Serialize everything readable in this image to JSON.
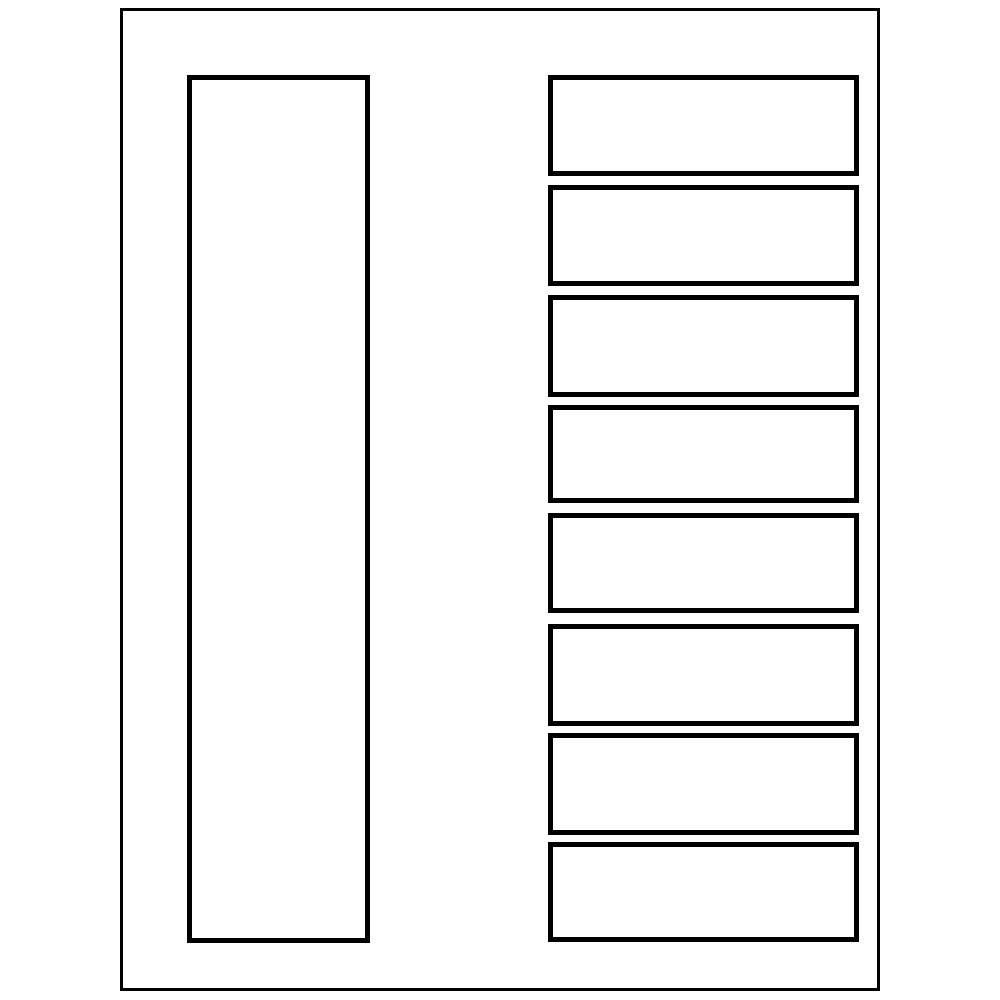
{
  "canvas": {
    "width": 1000,
    "height": 1000,
    "background_color": "#ffffff",
    "line_color": "#000000"
  },
  "page_border": {
    "name": "page-border",
    "x": 120,
    "y": 8,
    "width": 760,
    "height": 983,
    "stroke_width": 3,
    "stroke": "#000000",
    "fill": "#ffffff"
  },
  "left_label": {
    "name": "left-spine-label-outline",
    "x": 187,
    "y": 75,
    "width": 183,
    "height": 868,
    "stroke_width": 5,
    "stroke": "#000000",
    "fill": "#ffffff"
  },
  "right_labels": {
    "name_prefix": "right-label-outline",
    "x": 548,
    "width": 311,
    "stroke_width": 5,
    "stroke": "#000000",
    "fill": "#ffffff",
    "items": [
      {
        "index": 1,
        "y": 75,
        "height": 101
      },
      {
        "index": 2,
        "y": 185,
        "height": 101
      },
      {
        "index": 3,
        "y": 295,
        "height": 102
      },
      {
        "index": 4,
        "y": 405,
        "height": 98
      },
      {
        "index": 5,
        "y": 513,
        "height": 100
      },
      {
        "index": 6,
        "y": 624,
        "height": 102
      },
      {
        "index": 7,
        "y": 733,
        "height": 102
      },
      {
        "index": 8,
        "y": 842,
        "height": 100
      }
    ]
  }
}
